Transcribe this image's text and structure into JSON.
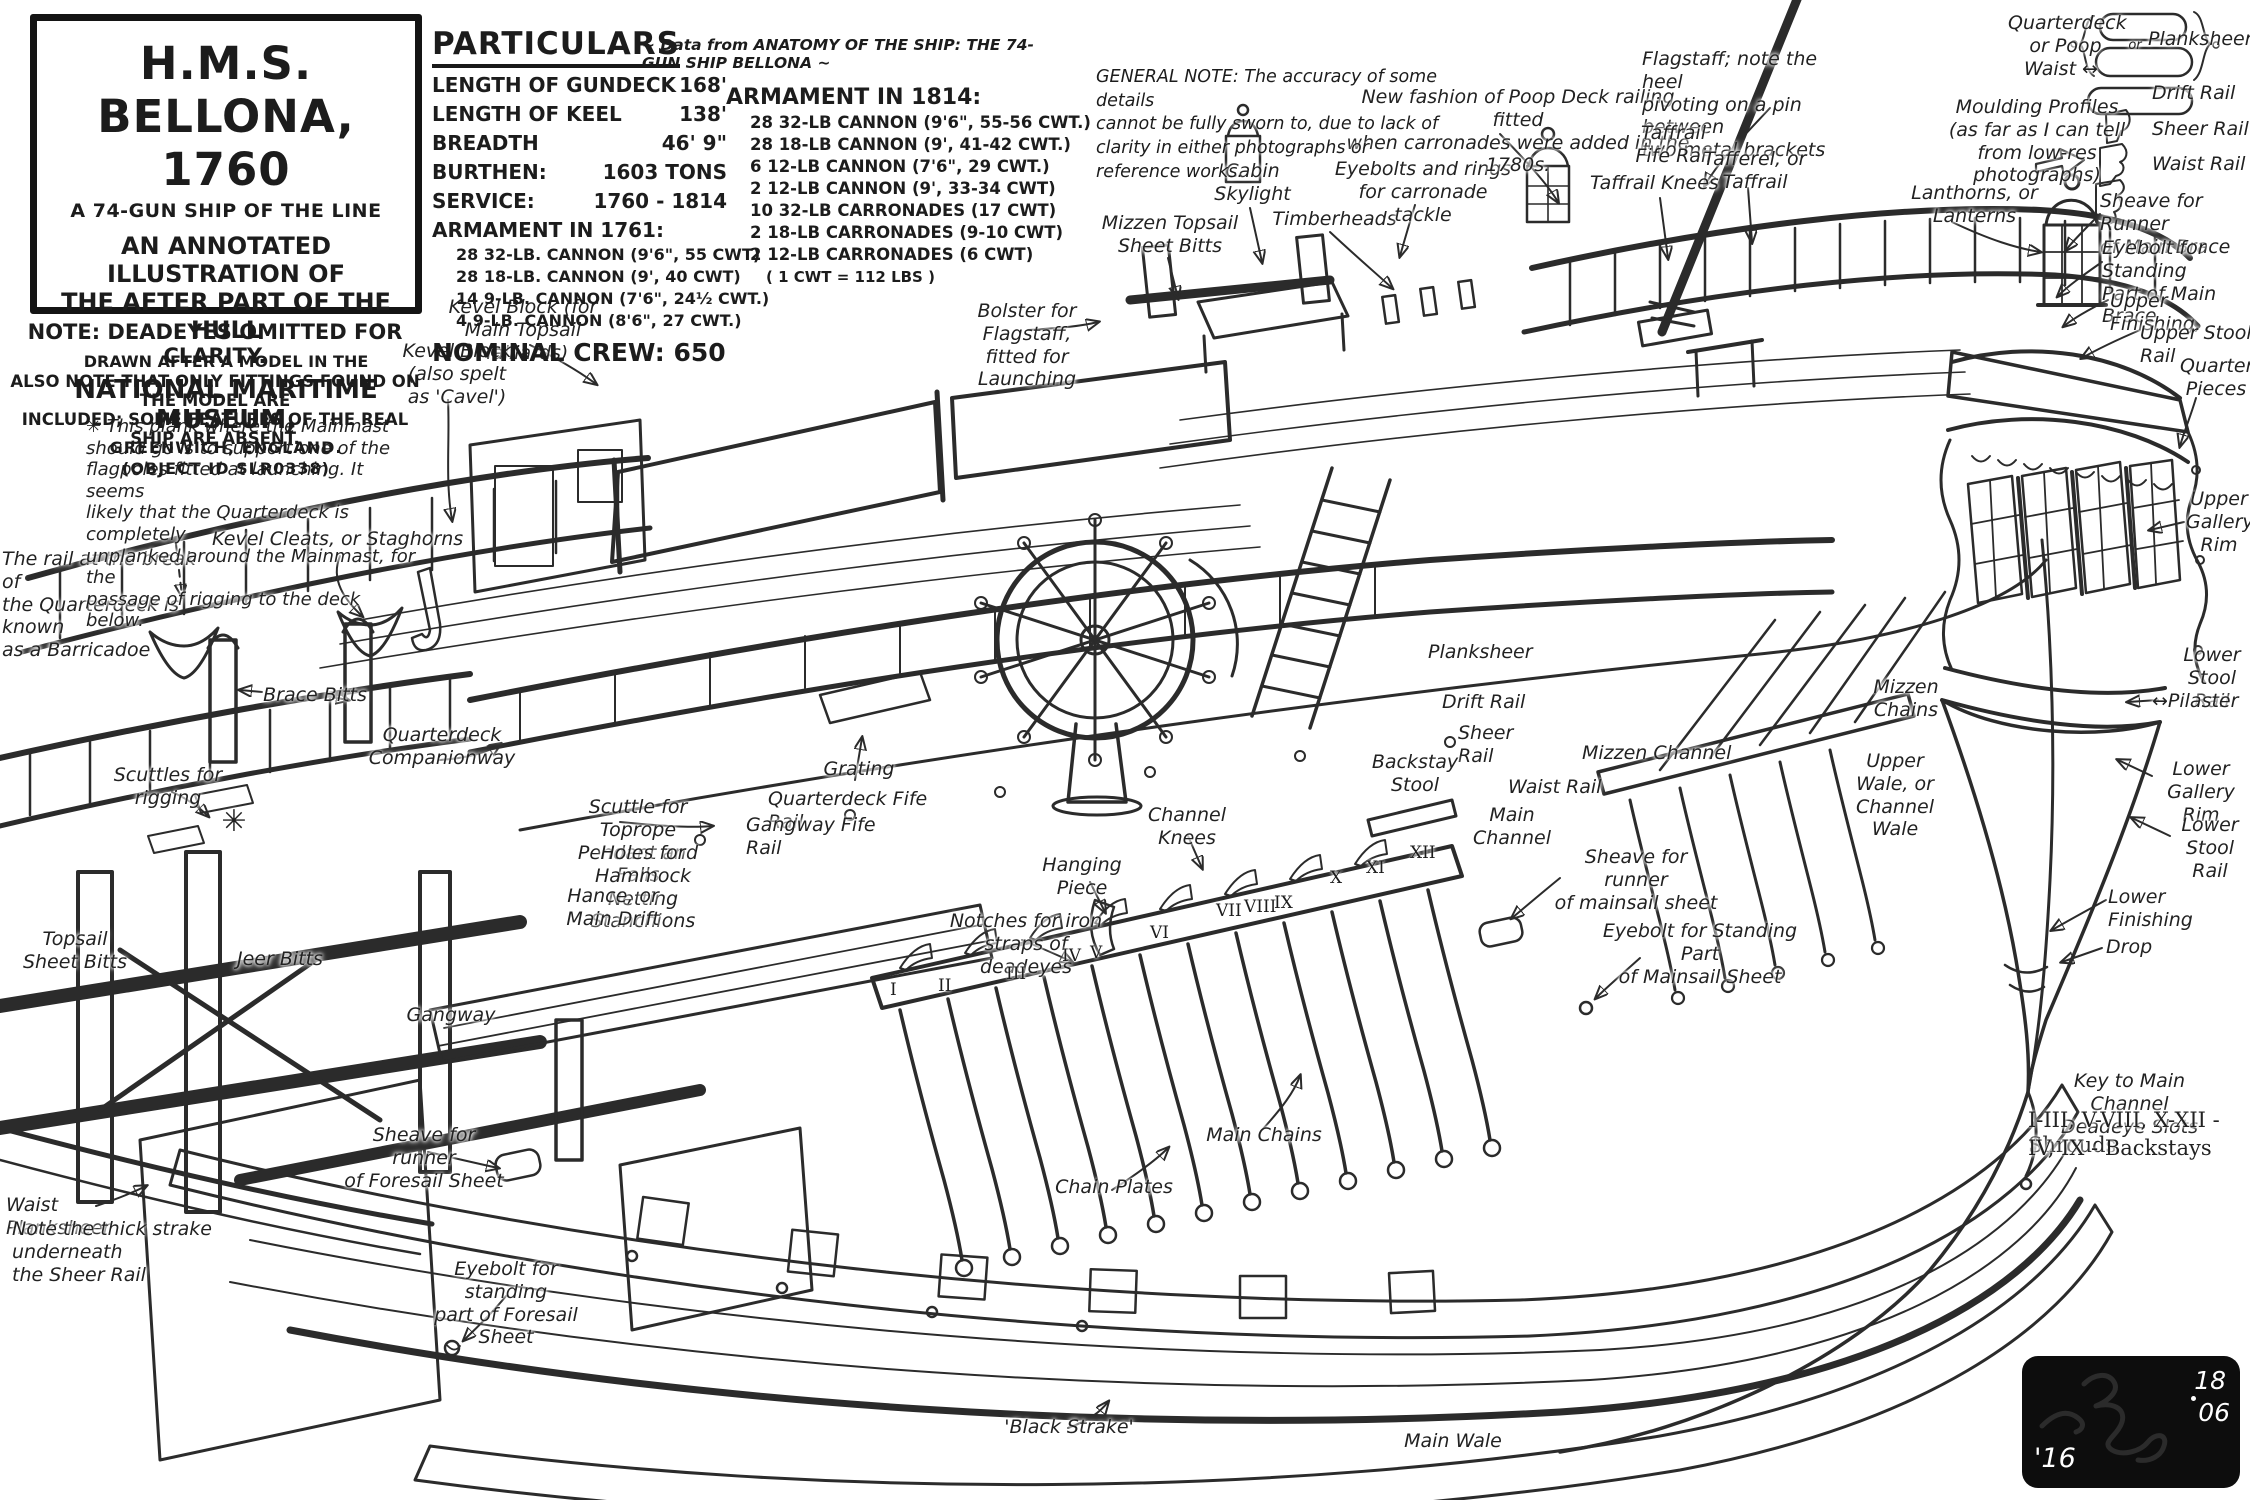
{
  "title_block": {
    "title": "H.M.S. BELLONA, 1760",
    "line2": "A 74-GUN SHIP OF THE LINE",
    "line3": "AN ANNOTATED ILLUSTRATION OF",
    "line4": "THE AFTER PART OF THE HULL",
    "line5": "DRAWN AFTER A MODEL IN THE",
    "line6": "NATIONAL MARITIME MUSEUM,",
    "line7": "GREENWICH, ENGLAND.",
    "line8": "(OBJECT ID SLR0338)"
  },
  "notes": {
    "lines": [
      "NOTE: DEADEYES OMITTED FOR CLARITY.",
      "ALSO NOTE THAT ONLY FITTINGS FOUND ON THE MODEL ARE",
      "INCLUDED; SOME FEATURES OF THE REAL SHIP ARE ABSENT."
    ]
  },
  "particulars": {
    "heading": "PARTICULARS",
    "source": "~ Data from ANATOMY OF THE SHIP: THE 74-GUN SHIP BELLONA ~",
    "specs": [
      {
        "label": "LENGTH OF GUNDECK",
        "value": "168'"
      },
      {
        "label": "LENGTH OF KEEL",
        "value": "138'"
      },
      {
        "label": "BREADTH",
        "value": "46' 9\""
      },
      {
        "label": "BURTHEN:",
        "value": "1603 TONS"
      },
      {
        "label": "SERVICE:",
        "value": "1760 - 1814"
      }
    ],
    "armament_1761_heading": "ARMAMENT IN 1761:",
    "armament_1761": [
      "28 32-LB. CANNON (9'6\", 55 CWT)",
      "28 18-LB. CANNON (9', 40 CWT)",
      "14 9-LB. CANNON (7'6\", 24½ CWT.)",
      "4  9-LB. CANNON (8'6\", 27 CWT.)"
    ],
    "crew": "NOMINAL CREW: 650",
    "armament_1814_heading": "ARMAMENT IN 1814:",
    "armament_1814": [
      "28 32-LB CANNON (9'6\", 55-56 CWT.)",
      "28 18-LB CANNON (9', 41-42 CWT.)",
      "6 12-LB CANNON (7'6\", 29 CWT.)",
      "2 12-LB CANNON (9', 33-34 CWT)",
      "10 32-LB CARRONADES (17 CWT)",
      "2 18-LB CARRONADES (9-10 CWT)",
      "2 12-LB CARRONADES (6 CWT)"
    ],
    "cwt_note": "( 1 CWT = 112 LBS )"
  },
  "general_note": {
    "lines": [
      "GENERAL NOTE:  The accuracy of some details",
      "cannot be fully sworn to, due to lack of",
      "clarity in either photographs or",
      "reference works."
    ]
  },
  "signature": {
    "year": "'16",
    "d1": "18",
    "d2": "06"
  },
  "annotations": [
    {
      "t": "Mizzen Topsail\nSheet Bitts",
      "x": 1100,
      "y": 212,
      "w": 140
    },
    {
      "t": "Cabin\nSkylight",
      "x": 1205,
      "y": 160,
      "w": 95
    },
    {
      "t": "Timberheads",
      "x": 1272,
      "y": 208,
      "w": 125
    },
    {
      "t": "Eyebolts and rings\nfor carronade tackle",
      "x": 1328,
      "y": 158,
      "w": 190
    },
    {
      "t": "New fashion of Poop Deck railing fitted\nwhen carronades were added in the 1780s.",
      "x": 1338,
      "y": 86,
      "w": 360
    },
    {
      "t": "Flagstaff; note the heel\npivoting on a pin between\ntwo metal brackets",
      "x": 1642,
      "y": 48,
      "w": 220,
      "a": "left"
    },
    {
      "t": "Taffrail\nFife Rail",
      "x": 1626,
      "y": 122,
      "w": 95
    },
    {
      "t": "Tafferel, or\nTaffrail",
      "x": 1700,
      "y": 148,
      "w": 110
    },
    {
      "t": "Taffrail Knees",
      "x": 1590,
      "y": 172,
      "w": 145,
      "a": "left"
    },
    {
      "t": "Lanthorns, or\nLanterns",
      "x": 1902,
      "y": 182,
      "w": 145
    },
    {
      "t": "Moulding Profiles\n(as far as I can tell\nfrom low-res photographs)",
      "x": 1912,
      "y": 96,
      "w": 250
    },
    {
      "t": "Quarterdeck\nor Poop",
      "x": 2008,
      "y": 12,
      "w": 115
    },
    {
      "t": "Planksheers",
      "x": 2148,
      "y": 28,
      "w": 100,
      "a": "left"
    },
    {
      "t": "Waist ↔",
      "x": 2024,
      "y": 58,
      "w": 85,
      "a": "left"
    },
    {
      "t": "or",
      "x": 2120,
      "y": 38,
      "w": 30,
      "s": 13
    },
    {
      "t": "Drift Rail",
      "x": 2152,
      "y": 82,
      "w": 95,
      "a": "left"
    },
    {
      "t": "Sheer Rail",
      "x": 2152,
      "y": 118,
      "w": 98,
      "a": "left"
    },
    {
      "t": "Waist Rail",
      "x": 2152,
      "y": 153,
      "w": 98,
      "a": "left"
    },
    {
      "t": "Sheave for Runner\nof Main Brace",
      "x": 2100,
      "y": 190,
      "w": 150,
      "a": "left"
    },
    {
      "t": "Eyebolt for Standing\nPart of Main Brace",
      "x": 2102,
      "y": 237,
      "w": 150,
      "a": "left"
    },
    {
      "t": "Upper Finishing,",
      "x": 2110,
      "y": 290,
      "w": 140,
      "a": "left"
    },
    {
      "t": "Upper Stool Rail",
      "x": 2140,
      "y": 322,
      "w": 112,
      "a": "left"
    },
    {
      "t": "Quarter\nPieces",
      "x": 2180,
      "y": 355,
      "w": 72
    },
    {
      "t": "Upper\nGallery\nRim",
      "x": 2186,
      "y": 488,
      "w": 66
    },
    {
      "t": "Lower\nStool Rail",
      "x": 2172,
      "y": 644,
      "w": 80
    },
    {
      "t": "↔Pilaster",
      "x": 2152,
      "y": 690,
      "w": 98,
      "a": "left"
    },
    {
      "t": "Lower\nGallery Rim",
      "x": 2150,
      "y": 758,
      "w": 102
    },
    {
      "t": "Lower\nStool Rail",
      "x": 2168,
      "y": 814,
      "w": 84
    },
    {
      "t": "Lower Finishing",
      "x": 2108,
      "y": 886,
      "w": 138,
      "a": "left"
    },
    {
      "t": "Drop",
      "x": 2106,
      "y": 936,
      "w": 60,
      "a": "left"
    },
    {
      "t": "Key to Main Channel\nDeadeye Slots",
      "x": 2032,
      "y": 1070,
      "w": 195
    },
    {
      "t": "I-III, V-VIII, X-XII  - Shrouds",
      "x": 2028,
      "y": 1108,
      "w": 222,
      "a": "left",
      "c": "key"
    },
    {
      "t": "IV, IX  - Backstays",
      "x": 2028,
      "y": 1136,
      "w": 185,
      "a": "left",
      "c": "key"
    },
    {
      "t": "Bolster for Flagstaff,\nfitted for Launching",
      "x": 938,
      "y": 300,
      "w": 178
    },
    {
      "t": "Kevel Block (for\nMain Topsail Halliards)",
      "x": 418,
      "y": 296,
      "w": 210
    },
    {
      "t": "Kevel Block\n(also spelt\nas 'Cavel')",
      "x": 398,
      "y": 340,
      "w": 118
    },
    {
      "t": "Kevel Cleats, or Staghorns",
      "x": 212,
      "y": 528,
      "w": 265,
      "a": "left"
    },
    {
      "t": "The rail at the break of\nthe Quarterdeck is known\nas a Barricadoe",
      "x": 2,
      "y": 548,
      "w": 208,
      "a": "left"
    },
    {
      "t": "✳ This plank where the Mainmast\nshould go is to support one of the\nflagpoles fitted at launching. It seems\nlikely that the Quarterdeck is completely\nunplanked around the Mainmast, for the\npassage of rigging to the deck below.",
      "x": 86,
      "y": 416,
      "w": 335,
      "a": "left",
      "s": 18
    },
    {
      "t": "✳",
      "x": 212,
      "y": 804,
      "w": 44,
      "s": 30
    },
    {
      "t": "Brace Bitts",
      "x": 256,
      "y": 684,
      "w": 118
    },
    {
      "t": "Quarterdeck\nCompanionway",
      "x": 368,
      "y": 724,
      "w": 148
    },
    {
      "t": "Scuttles for\nrigging",
      "x": 112,
      "y": 764,
      "w": 112
    },
    {
      "t": "Scuttle for Toprope\nPendant and Falls",
      "x": 554,
      "y": 796,
      "w": 168
    },
    {
      "t": "Quarterdeck Fife Rail",
      "x": 768,
      "y": 788,
      "w": 198,
      "a": "left"
    },
    {
      "t": "Gangway Fife Rail",
      "x": 746,
      "y": 814,
      "w": 168,
      "a": "left"
    },
    {
      "t": "Grating",
      "x": 815,
      "y": 758,
      "w": 88
    },
    {
      "t": "Holes for Hammock\nNetting Stanchions",
      "x": 554,
      "y": 842,
      "w": 178
    },
    {
      "t": "Hance, or\nMain Drift",
      "x": 560,
      "y": 885,
      "w": 106
    },
    {
      "t": "Topsail\nSheet Bitts",
      "x": 16,
      "y": 928,
      "w": 118
    },
    {
      "t": "Jeer Bitts",
      "x": 226,
      "y": 948,
      "w": 108
    },
    {
      "t": "Gangway",
      "x": 402,
      "y": 1004,
      "w": 98
    },
    {
      "t": "Notches for iron\nstraps of deadeyes",
      "x": 942,
      "y": 910,
      "w": 168
    },
    {
      "t": "Hanging\nPiece",
      "x": 1036,
      "y": 854,
      "w": 92
    },
    {
      "t": "Channel\nKnees",
      "x": 1140,
      "y": 804,
      "w": 94
    },
    {
      "t": "Planksheer",
      "x": 1428,
      "y": 641,
      "w": 112,
      "a": "left"
    },
    {
      "t": "Drift Rail",
      "x": 1442,
      "y": 691,
      "w": 94,
      "a": "left"
    },
    {
      "t": "Sheer Rail",
      "x": 1458,
      "y": 722,
      "w": 96,
      "a": "left"
    },
    {
      "t": "Backstay\nStool",
      "x": 1368,
      "y": 751,
      "w": 94
    },
    {
      "t": "Waist Rail",
      "x": 1508,
      "y": 776,
      "w": 96,
      "a": "left"
    },
    {
      "t": "Main\nChannel",
      "x": 1470,
      "y": 804,
      "w": 84
    },
    {
      "t": "Mizzen Channel",
      "x": 1582,
      "y": 742,
      "w": 158,
      "a": "left"
    },
    {
      "t": "Mizzen\nChains",
      "x": 1864,
      "y": 676,
      "w": 84
    },
    {
      "t": "Upper\nWale, or\nChannel\nWale",
      "x": 1848,
      "y": 750,
      "w": 94
    },
    {
      "t": "Sheave for runner\nof mainsail sheet",
      "x": 1552,
      "y": 846,
      "w": 168
    },
    {
      "t": "Eyebolt for Standing Part\nof Mainsail Sheet",
      "x": 1590,
      "y": 920,
      "w": 220
    },
    {
      "t": "Main Chains",
      "x": 1200,
      "y": 1124,
      "w": 128
    },
    {
      "t": "Chain Plates",
      "x": 1050,
      "y": 1176,
      "w": 128
    },
    {
      "t": "Sheave for runner\nof Foresail Sheet",
      "x": 340,
      "y": 1124,
      "w": 168
    },
    {
      "t": "Waist Planksheer",
      "x": 6,
      "y": 1194,
      "w": 158,
      "a": "left"
    },
    {
      "t": "Note the thick strake underneath\nthe Sheer Rail",
      "x": 12,
      "y": 1218,
      "w": 238,
      "a": "left"
    },
    {
      "t": "Eyebolt for standing\npart of Foresail Sheet",
      "x": 412,
      "y": 1258,
      "w": 188
    },
    {
      "t": "'Black Strake'",
      "x": 1000,
      "y": 1416,
      "w": 138
    },
    {
      "t": "Main Wale",
      "x": 1402,
      "y": 1430,
      "w": 102
    }
  ],
  "numerals": [
    {
      "t": "I",
      "x": 890,
      "y": 980
    },
    {
      "t": "II",
      "x": 938,
      "y": 976
    },
    {
      "t": "III",
      "x": 1006,
      "y": 964
    },
    {
      "t": "IV",
      "x": 1062,
      "y": 946
    },
    {
      "t": "V",
      "x": 1090,
      "y": 943
    },
    {
      "t": "VI",
      "x": 1150,
      "y": 923
    },
    {
      "t": "VII",
      "x": 1216,
      "y": 901
    },
    {
      "t": "VIII",
      "x": 1244,
      "y": 897
    },
    {
      "t": "IX",
      "x": 1274,
      "y": 893
    },
    {
      "t": "X",
      "x": 1330,
      "y": 868
    },
    {
      "t": "XI",
      "x": 1366,
      "y": 858
    },
    {
      "t": "XII",
      "x": 1410,
      "y": 843
    }
  ]
}
